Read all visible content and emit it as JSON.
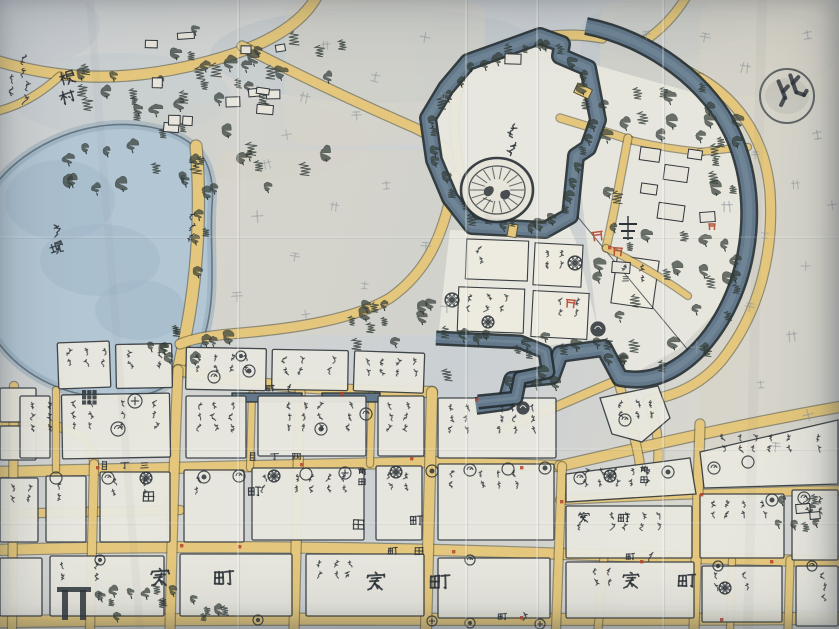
{
  "map": {
    "compass_seal": "北",
    "castle_label": "御城",
    "lake_label": "蓮堀",
    "village": {
      "name": "根村",
      "annotation": "武永義民",
      "annotation_2": "雀居"
    },
    "road_label": "往還道",
    "street_names": [
      "四丁目",
      "三丁目",
      "田町",
      "横町",
      "新町",
      "中町"
    ],
    "block_labels": [
      "町家",
      "町家",
      "町家",
      "田",
      "町",
      "田",
      "町",
      "町家"
    ],
    "lot_names": [
      "前田",
      "前田"
    ],
    "field_marks": [
      "十",
      "干",
      "廾",
      "士"
    ],
    "palette": {
      "paper": "#ced2d4",
      "road": "#e4c77c",
      "water": "#aec2d1",
      "moat": "#63798b",
      "ink": "#2c3238",
      "block": "#e9e8df",
      "field": "#d8d4c6",
      "accent_red": "#b5452f"
    }
  }
}
